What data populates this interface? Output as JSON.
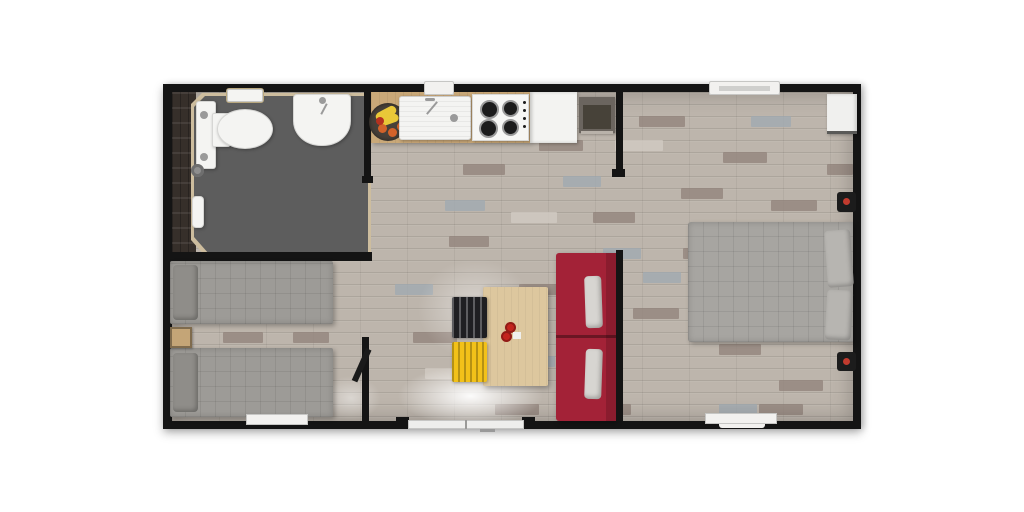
{
  "scene": {
    "type": "floor-plan-3d-top-view",
    "rooms": [
      {
        "name": "bathroom",
        "fixtures": [
          "toilet",
          "washbasin",
          "wall-shelf-window",
          "floor-drain",
          "towel-radiator",
          "dark-tiled-wall"
        ]
      },
      {
        "name": "kitchen",
        "fixtures": [
          "fruit-bowl",
          "sink-with-faucet",
          "gas-hob-4-burners",
          "refrigerator",
          "dark-appliance",
          "window-above-sink"
        ]
      },
      {
        "name": "twin-bedroom",
        "fixtures": [
          "twin-bed-1",
          "twin-bed-2",
          "nightstand",
          "bottom-window",
          "open-door"
        ]
      },
      {
        "name": "living-dining",
        "fixtures": [
          "dining-table",
          "black-chair",
          "yellow-chair",
          "red-sofa-two-seats",
          "entrance-french-door",
          "two-red-cups"
        ]
      },
      {
        "name": "double-bedroom",
        "fixtures": [
          "double-bed",
          "two-pillows",
          "wardrobe",
          "wall-heater-1",
          "wall-heater-2",
          "top-window",
          "bottom-window"
        ]
      }
    ]
  },
  "colors": {
    "page_bg": "#ffffff",
    "wall": "#141414",
    "floor_wood": "#bdb5ac",
    "plank_dark": "#90827a",
    "plank_blue": "#9fa9b2",
    "plank_light": "#d3ccc4",
    "bathroom_trim": "#cdbd9e",
    "bathroom_floor": "#5d5d5d",
    "bathroom_dark_wall": "#362f2a",
    "porcelain": "#f4f4f2",
    "chrome": "#9a9a9a",
    "drain": "#8e8e8e",
    "counter": "#c9a878",
    "hob_white": "#f6f6f4",
    "burner": "#1c1c1c",
    "fridge": "#f3f3f1",
    "appliance_body": "#6b655f",
    "appliance_front": "#474239",
    "appliance_base": "#b9b2aa",
    "twin_bed": "#9d9b97",
    "twin_pillow": "#8f8d89",
    "double_bed": "#a7a5a1",
    "double_pillow": "#b7b5b1",
    "nightstand": "#c4a577",
    "sofa": "#a32237",
    "sofa_dark": "#8a1c2e",
    "sofa_pillow": "#d7d5d1",
    "table": "#ddc79e",
    "cup_red": "#c3251e",
    "cup_white": "#efefed",
    "chair_black": "#1f1f22",
    "chair_yellow": "#f2c119",
    "window": "#f2f1ef",
    "door_white": "#eeeeec",
    "door_leaf": "#1a1a1a",
    "handle": "#999999",
    "heater": "#1c1c1c",
    "heater_dot": "#c23b2e",
    "wardrobe": "#f0f0ee",
    "wardrobe_base": "#5a5a58",
    "bowl": "#474039",
    "banana": "#e9c838",
    "orange": "#d2622a",
    "apple": "#b5311f"
  }
}
